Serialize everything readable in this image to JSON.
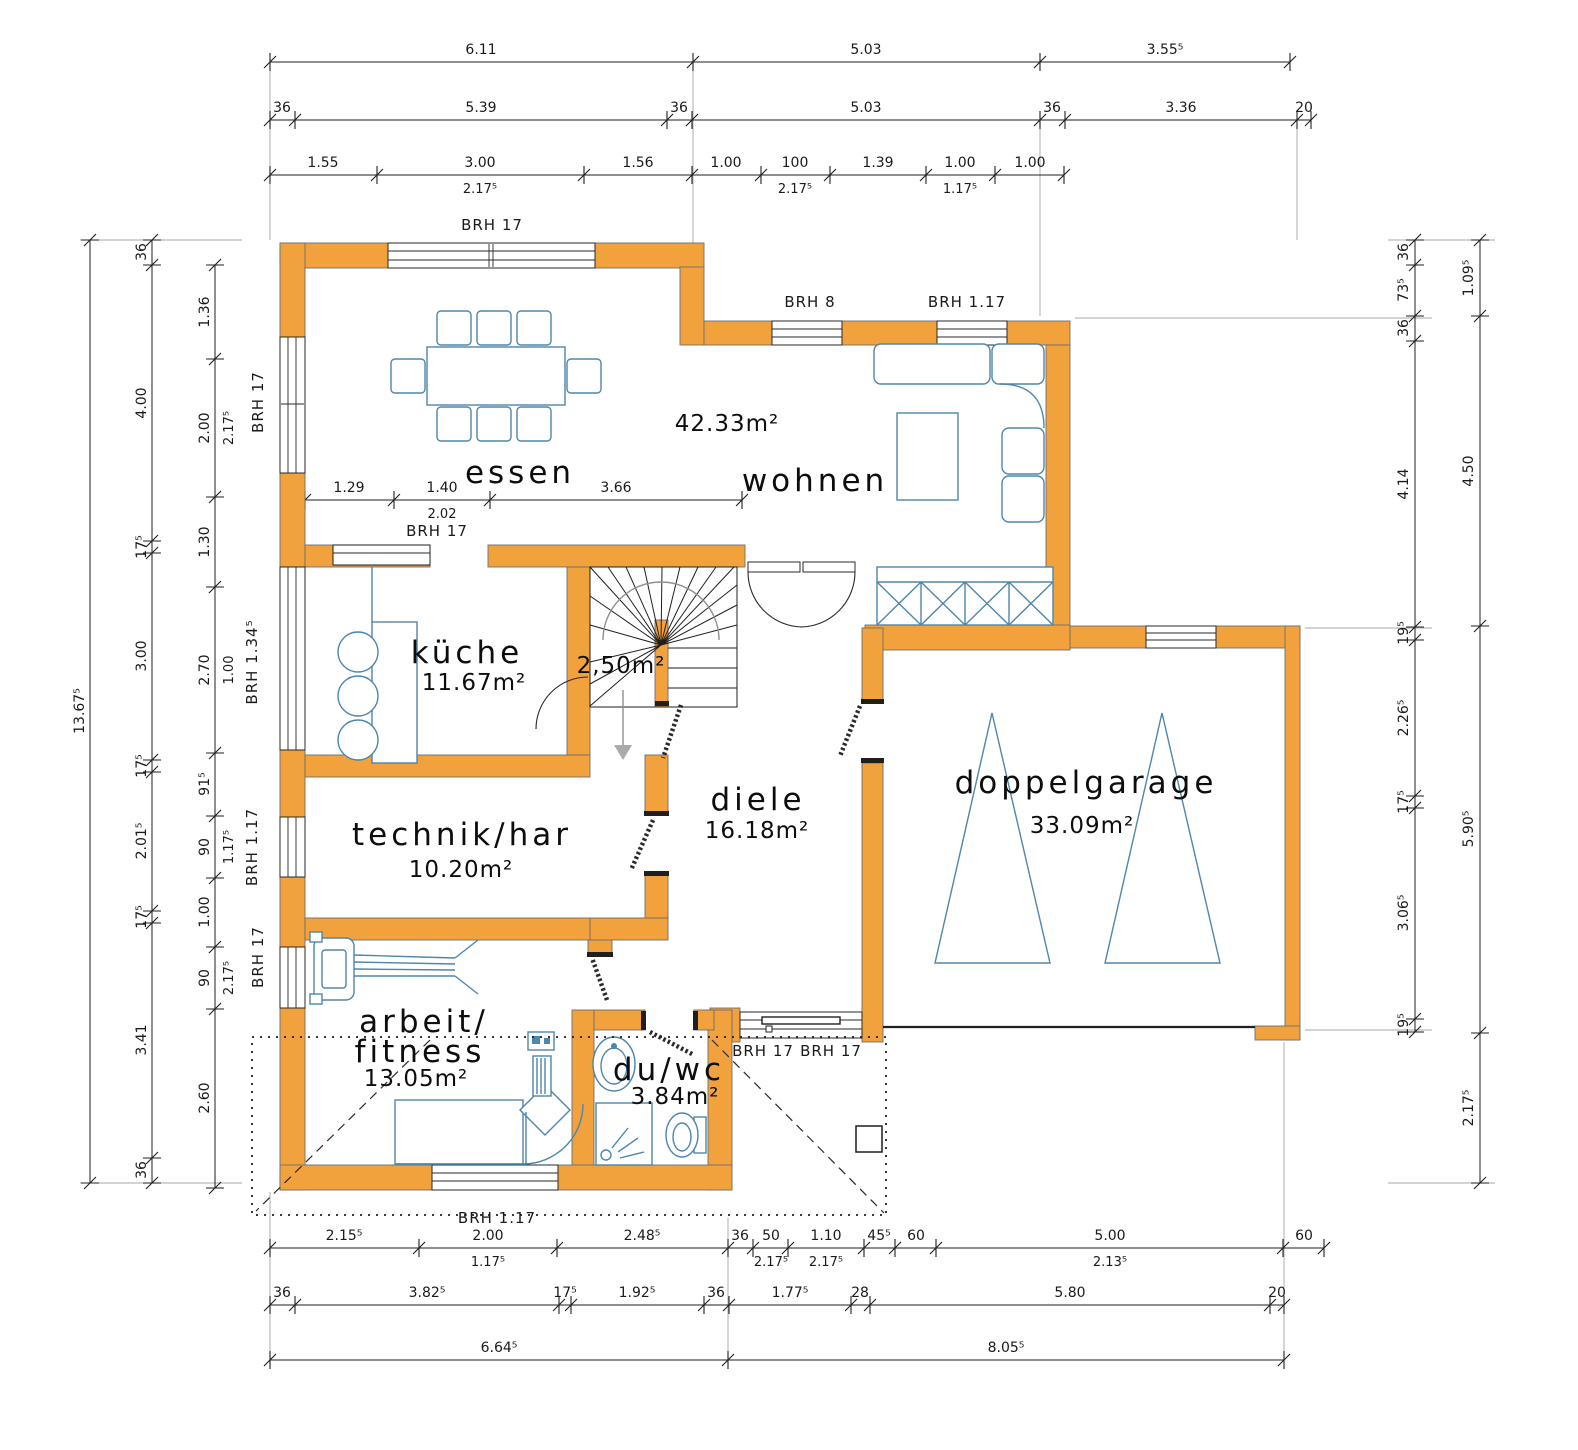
{
  "colors": {
    "wall_orange": "#F2A23C",
    "furniture_blue": "#4E86AC",
    "line_black": "#1f1f1f"
  },
  "rooms": {
    "essen": {
      "name": "essen"
    },
    "wohnen": {
      "name": "wohnen",
      "area": "42.33m²"
    },
    "kueche": {
      "name": "küche",
      "area": "11.67m²"
    },
    "stairs": {
      "area": "2,50m²"
    },
    "diele": {
      "name": "diele",
      "area": "16.18m²"
    },
    "technik": {
      "name": "technik/har",
      "area": "10.20m²"
    },
    "arbeit": {
      "name1": "arbeit/",
      "name2": "fitness",
      "area": "13.05m²"
    },
    "duwc": {
      "name": "du/wc",
      "area": "3.84m²"
    },
    "garage": {
      "name": "doppelgarage",
      "area": "33.09m²"
    }
  },
  "brh": {
    "essen_top": "BRH 17",
    "wohnen_win1": "BRH 8",
    "wohnen_win2": "BRH 1.17",
    "left_win1": "BRH 17",
    "left_win2": "BRH 1.34⁵",
    "left_win3": "BRH 1.17",
    "left_win4": "BRH 17",
    "essen_inner": "BRH 17",
    "entry_a": "BRH 17",
    "entry_b": "BRH 17",
    "arbeit_bottom": "BRH 1.17"
  },
  "dims": {
    "top1": [
      "6.11",
      "5.03",
      "3.55⁵"
    ],
    "top2": [
      "36",
      "5.39",
      "36",
      "5.03",
      "36",
      "3.36",
      "20"
    ],
    "top3": [
      "1.55",
      "3.00",
      "1.56",
      "1.00",
      "100",
      "1.39",
      "1.00",
      "1.00"
    ],
    "top3sub": [
      "2.17⁵",
      "2.17⁵",
      "1.17⁵"
    ],
    "bot1": [
      "2.15⁵",
      "2.00",
      "2.48⁵",
      "36",
      "50",
      "1.10",
      "45⁵",
      "60",
      "5.00",
      "60"
    ],
    "bot1sub": [
      "1.17⁵",
      "2.17⁵",
      "2.17⁵",
      "2.13⁵"
    ],
    "bot2": [
      "36",
      "3.82⁵",
      "17⁵",
      "1.92⁵",
      "36",
      "1.77⁵",
      "28",
      "5.80",
      "20"
    ],
    "bot3": [
      "6.64⁵",
      "8.05⁵"
    ],
    "left1": [
      "13.67⁵"
    ],
    "left2": [
      "36",
      "4.00",
      "17⁵",
      "3.00",
      "17⁵",
      "2.01⁵",
      "17⁵",
      "3.41",
      "36"
    ],
    "left3": [
      "1.36",
      "2.00",
      "1.30",
      "2.70",
      "91⁵",
      "90",
      "1.00",
      "90",
      "2.60"
    ],
    "left3sub": [
      "2.17⁵",
      "1.00",
      "1.17⁵",
      "2.17⁵"
    ],
    "right1": [
      "36",
      "73⁵",
      "36",
      "4.14",
      "19⁵",
      "2.26⁵",
      "17⁵",
      "3.06⁵",
      "19⁵"
    ],
    "right2": [
      "1.09⁵",
      "4.50",
      "5.90⁵",
      "2.17⁵"
    ],
    "inner": [
      "1.29",
      "1.40",
      "3.66"
    ],
    "innersub": [
      "2.02"
    ]
  }
}
